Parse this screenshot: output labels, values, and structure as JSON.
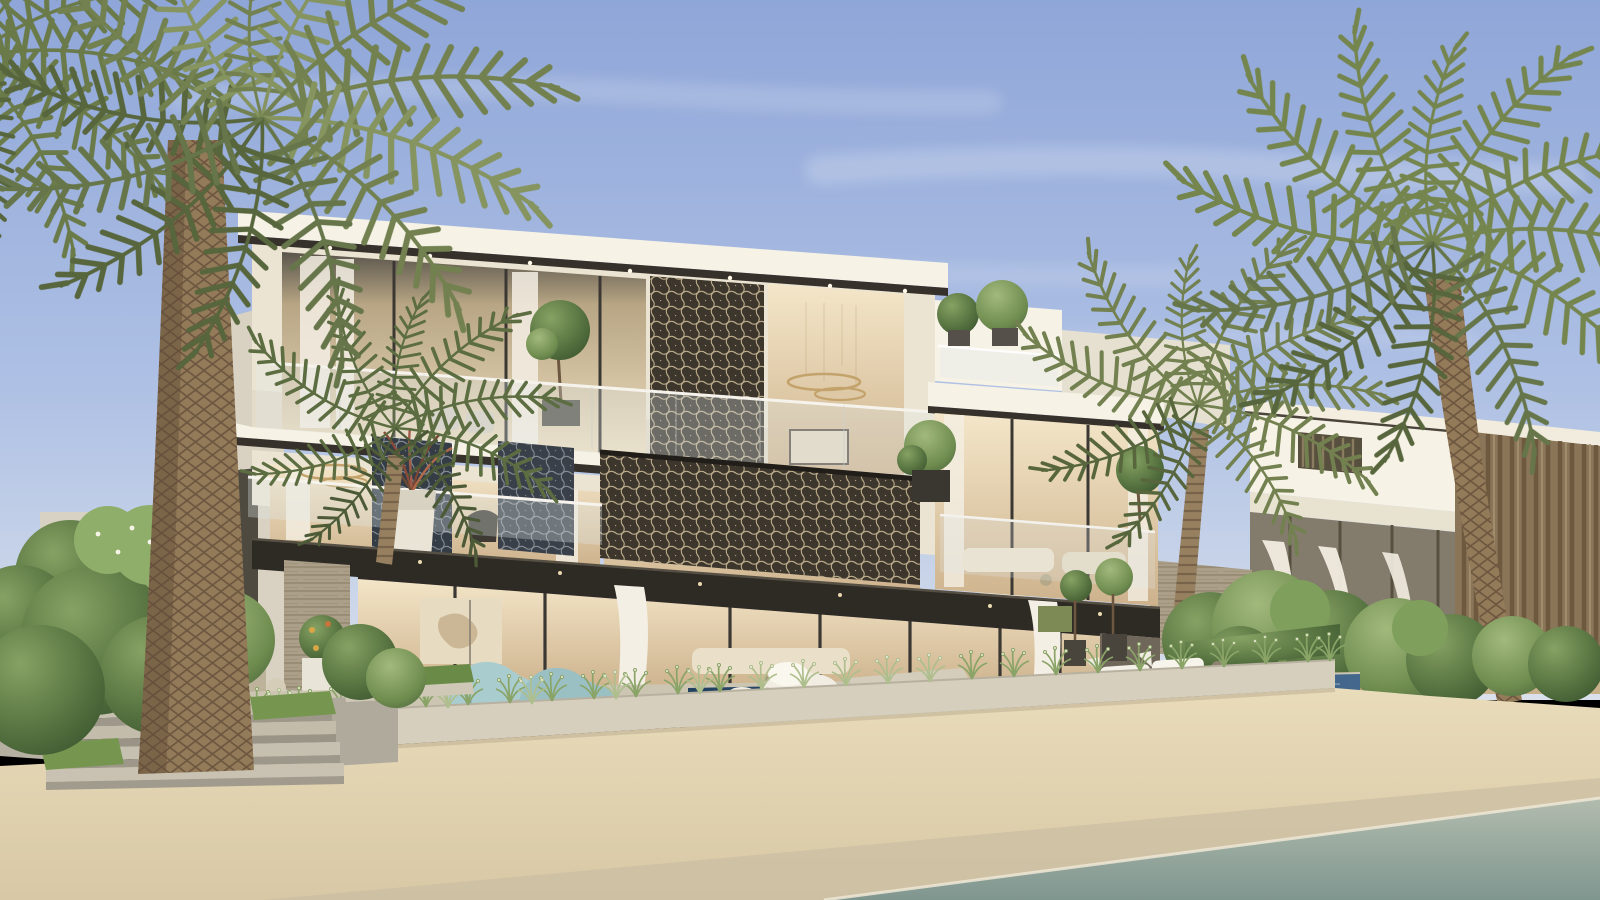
{
  "meta": {
    "title": "Luxury beachfront villa — photorealistic architectural rendering",
    "type": "architectural-render",
    "width": 1600,
    "height": 900
  },
  "scene": {
    "description": "Three-storey contemporary beachfront villa with bronze geometric mashrabiya screens, glass balustrades, warm lit interiors, infinity pool with mosaic edge, ornamental grass planter, stone steps, date palms on both sides, neighbouring villa with timber louvres, sandy beach and shoreline water in the foreground.",
    "time_of_day": "dusk",
    "elements": [
      "sky",
      "cloud-streaks",
      "main-villa",
      "roof-slab",
      "mashrabiya-screens",
      "glass-balustrades",
      "warm-interiors",
      "ring-chandeliers",
      "balcony-planters",
      "stone-pier",
      "ground-floor-glass-wall",
      "dark-canopy",
      "neighbor-villa",
      "timber-louvre-facade",
      "billowing-curtains",
      "wicker-sofas",
      "infinity-pool",
      "mosaic-cascade-edge",
      "diving-platform",
      "white-loungers",
      "teal-loungers",
      "white-rock-sculpture",
      "grass-planter-wall",
      "ornamental-grasses",
      "stone-steps",
      "lawn-patches",
      "garden-bushes",
      "date-palms",
      "beach-sand",
      "shoreline-water"
    ]
  },
  "palette": {
    "sky_top": "#8fa6d8",
    "sky_mid": "#aec0e4",
    "sky_horizon": "#dae1ec",
    "cloud": "#ffffff",
    "wall_white": "#f6f2e6",
    "wall_cream": "#ece4d2",
    "wall_shade": "#d9d2c2",
    "fascia_dark": "#36312a",
    "canopy_dark": "#2e2a24",
    "screen_dark": "#3c362d",
    "screen_lattice": "#d9c7a0",
    "interior_warm": "#f4e6c9",
    "interior_deep": "#cdb28c",
    "glass_tint": "#dfe8ea",
    "curtain": "#f4efe4",
    "gold_accent": "#c3a36b",
    "stone_pier": "#b4ab99",
    "deck_stone": "#ccc5b2",
    "planter_wall": "#d6cfbe",
    "step_stone": "#c3bcab",
    "pool_deep": "#23425f",
    "pool_mid": "#44688d",
    "pool_mosaic": "#6ea6c9",
    "sand_light": "#e9dcba",
    "sand_shade": "#d8c8a5",
    "sand_wet": "#cbbda2",
    "water_light": "#b2bcae",
    "water_deep": "#7f968f",
    "foam": "#efe8d6",
    "bush_dark": "#3b5430",
    "bush_mid": "#5c7a42",
    "bush_light": "#84a261",
    "grass_green": "#8aa468",
    "grass_pale": "#aebe8d",
    "palm_frond": "#72814f",
    "palm_frond_dark": "#57663c",
    "palm_frond_light": "#869460",
    "palm_trunk": "#937a58",
    "palm_trunk_dark": "#6d5740",
    "timber": "#8a7558",
    "timber_dark": "#6b573d",
    "lounger_teal": "#a9ccce",
    "lounger_white": "#f4f1e8",
    "wicker": "#b7a585"
  }
}
